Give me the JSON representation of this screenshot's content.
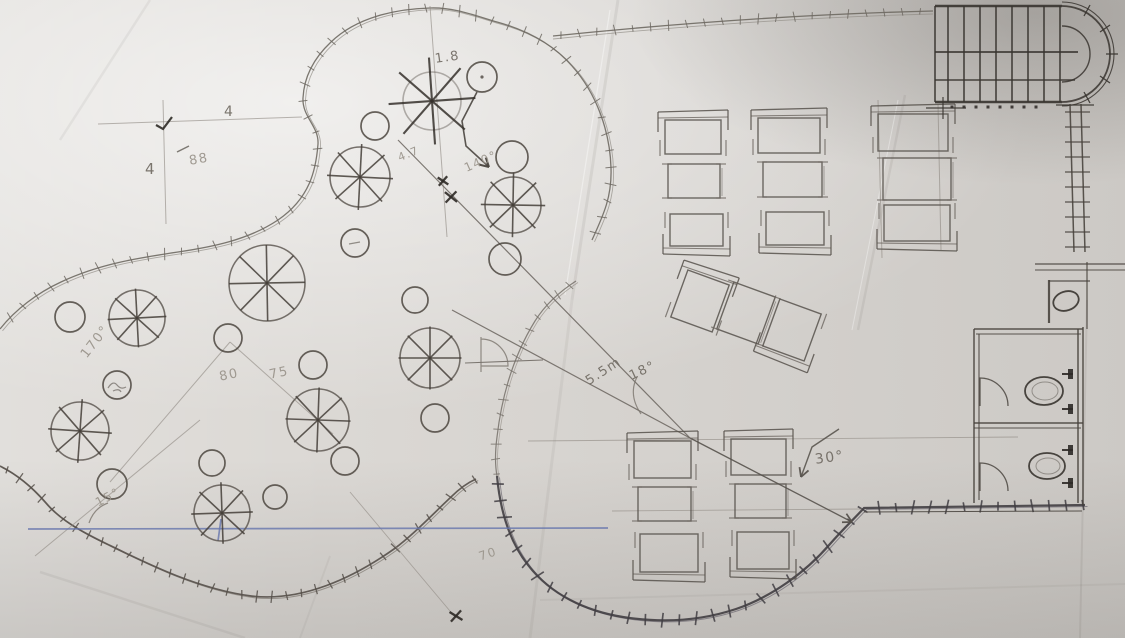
{
  "meta": {
    "canvas": {
      "w": 1125,
      "h": 638
    }
  },
  "palette": {
    "paper": "#dbd8d4",
    "pencil": "#6b655f",
    "pencil_faint": "#8d8780",
    "pencil_dark": "#3a3531",
    "ink_dark": "#413e43",
    "pen_blue": "#6776ad"
  },
  "annotations": [
    {
      "text": "1.8",
      "x": 434,
      "y": 52,
      "rot": -8,
      "size": 13,
      "tone": "normal"
    },
    {
      "text": "4",
      "x": 224,
      "y": 104,
      "rot": 0,
      "size": 14,
      "tone": "normal"
    },
    {
      "text": "4",
      "x": 145,
      "y": 160,
      "rot": 0,
      "size": 15,
      "tone": "normal"
    },
    {
      "text": "88",
      "x": 188,
      "y": 154,
      "rot": -10,
      "size": 13,
      "tone": "faint"
    },
    {
      "text": "4.7",
      "x": 396,
      "y": 152,
      "rot": -22,
      "size": 11,
      "tone": "faint"
    },
    {
      "text": "140°",
      "x": 462,
      "y": 162,
      "rot": -24,
      "size": 12,
      "tone": "faint"
    },
    {
      "text": "170°",
      "x": 78,
      "y": 352,
      "rot": -52,
      "size": 13,
      "tone": "faint"
    },
    {
      "text": "80",
      "x": 218,
      "y": 370,
      "rot": -12,
      "size": 13,
      "tone": "faint"
    },
    {
      "text": "75",
      "x": 268,
      "y": 368,
      "rot": -12,
      "size": 13,
      "tone": "faint"
    },
    {
      "text": "15°",
      "x": 93,
      "y": 497,
      "rot": -28,
      "size": 12,
      "tone": "faint"
    },
    {
      "text": "5.5m",
      "x": 583,
      "y": 376,
      "rot": -33,
      "size": 13,
      "tone": "normal"
    },
    {
      "text": "18°",
      "x": 627,
      "y": 370,
      "rot": -25,
      "size": 13,
      "tone": "normal"
    },
    {
      "text": "30°",
      "x": 814,
      "y": 452,
      "rot": -8,
      "size": 14,
      "tone": "normal"
    },
    {
      "text": "70",
      "x": 477,
      "y": 550,
      "rot": -18,
      "size": 12,
      "tone": "faint"
    }
  ],
  "sketch": {
    "boundaries": [
      {
        "name": "garden-boundary-top",
        "stroke": "#6e6962",
        "w": 1.3,
        "stroke2": "#908b84",
        "w2": 0.9,
        "off": [
          2.5,
          1.8
        ],
        "tick": 17,
        "ticklen": 9,
        "d": "M 592 240 C 604 214 612 196 611 168 C 610 132 597 94 572 66 C 552 43 526 30 497 22 C 476 16 454 7 430 8 C 396 9 357 17 331 42 C 314 58 304 77 303 98 C 302 117 319 126 318 144 C 316 170 310 198 278 220 C 248 240 212 247 178 252 C 138 258 99 264 61 282 C 37 293 15 310 0 329"
      },
      {
        "name": "garden-boundary-bottom-lobe",
        "stroke": "#56504a",
        "w": 1.7,
        "stroke2": "#7d7871",
        "w2": 1,
        "off": [
          2.2,
          1.6
        ],
        "tick": 15,
        "ticklen": 9,
        "d": "M 0 466 C 16 474 32 487 45 502 C 60 520 82 532 107 544 C 148 564 198 589 251 596 C 302 602 353 578 394 549 C 413 535 434 513 451 497 C 459 489 467 483 476 479"
      },
      {
        "name": "patio-circle-upper",
        "stroke": "#7b766f",
        "w": 1.2,
        "stroke2": "#968f88",
        "w2": 0.8,
        "off": [
          2,
          1.5
        ],
        "tick": 15,
        "ticklen": 8,
        "d": "M 576 281 C 559 292 545 305 535 321 C 514 355 502 394 497 437 C 495 452 495 465 497 476"
      },
      {
        "name": "patio-circle-lower-dark",
        "stroke": "#413e43",
        "w": 2.2,
        "stroke2": "#6c6870",
        "w2": 1,
        "off": [
          2.5,
          1.5
        ],
        "tick": 17,
        "ticklen": 11,
        "d": "M 497 476 C 500 509 509 541 528 565 C 551 595 586 611 623 617 C 661 623 700 621 736 609 C 771 597 805 573 830 544 C 844 528 855 518 864 508 L 1085 505"
      },
      {
        "name": "top-site-wall",
        "stroke": "#6e6962",
        "w": 1.3,
        "stroke2": "#908b84",
        "w2": 0.9,
        "off": [
          0,
          3
        ],
        "tick": 18,
        "ticklen": 8,
        "d": "M 553 36 C 680 23 810 14 933 11"
      }
    ],
    "lines": [
      [
        163,
        100,
        166,
        224,
        1.0,
        "faint"
      ],
      [
        98,
        124,
        302,
        117,
        1.0,
        "faint"
      ],
      [
        430,
        6,
        447,
        237,
        1.0,
        "faint"
      ],
      [
        398,
        140,
        690,
        438,
        1.2,
        "norm"
      ],
      [
        452,
        310,
        690,
        438,
        1.2,
        "norm"
      ],
      [
        230,
        342,
        110,
        482,
        1.0,
        "faint"
      ],
      [
        230,
        342,
        333,
        434,
        1.0,
        "faint"
      ],
      [
        200,
        420,
        35,
        556,
        1.0,
        "faint"
      ],
      [
        528,
        441,
        1018,
        437,
        0.9,
        "faint"
      ],
      [
        612,
        511,
        862,
        509,
        0.9,
        "faint"
      ],
      [
        465,
        363,
        543,
        360,
        1.1,
        "norm"
      ],
      [
        878,
        100,
        882,
        258,
        1.0,
        "faint"
      ],
      [
        938,
        104,
        941,
        250,
        1.0,
        "faint"
      ],
      [
        350,
        492,
        455,
        617,
        0.9,
        "faint"
      ],
      [
        177,
        152,
        189,
        146,
        1.5,
        "norm"
      ],
      [
        28,
        529,
        608,
        528,
        1.7,
        "blue"
      ],
      [
        221,
        519,
        218,
        541,
        1.7,
        "blue"
      ]
    ],
    "arcs": [
      "M 641 414 Q 628 395 637 377",
      "M 89 523 Q 94 508 108 503",
      "M 481 337 L 481 372 M 481 339 A 27 27 0 0 1 508 366 L 481 366"
    ],
    "arrows": [
      {
        "name": "curved-arrow",
        "pts": [
          [
            477,
            92
          ],
          [
            462,
            121
          ],
          [
            466,
            146
          ],
          [
            489,
            167
          ]
        ],
        "w": 1.6,
        "stroke": "#4a453f"
      },
      {
        "name": "dimension-arrow",
        "pts": [
          [
            690,
            438
          ],
          [
            852,
            522
          ]
        ],
        "w": 1.3,
        "stroke": "#57524c"
      },
      {
        "name": "angle-30-arrow",
        "pts": [
          [
            839,
            429
          ],
          [
            812,
            447
          ],
          [
            801,
            477
          ]
        ],
        "w": 1.4,
        "stroke": "#5a554f"
      }
    ],
    "trees": [
      {
        "x": 432,
        "y": 101,
        "r": 29,
        "s": 1.5,
        "faint": true,
        "dark": true
      },
      {
        "x": 360,
        "y": 177,
        "r": 30,
        "s": 1.1
      },
      {
        "x": 513,
        "y": 205,
        "r": 28,
        "s": 1.15
      },
      {
        "x": 267,
        "y": 283,
        "r": 38,
        "s": 1.0
      },
      {
        "x": 137,
        "y": 318,
        "r": 28,
        "s": 1.05
      },
      {
        "x": 80,
        "y": 431,
        "r": 29,
        "s": 1.1
      },
      {
        "x": 318,
        "y": 420,
        "r": 31,
        "s": 1.05
      },
      {
        "x": 430,
        "y": 358,
        "r": 30,
        "s": 1.05
      },
      {
        "x": 222,
        "y": 513,
        "r": 28,
        "s": 1.1
      }
    ],
    "shrubs": [
      {
        "x": 482,
        "y": 77,
        "r": 15,
        "dot": true
      },
      {
        "x": 375,
        "y": 126,
        "r": 14
      },
      {
        "x": 512,
        "y": 157,
        "r": 16
      },
      {
        "x": 355,
        "y": 243,
        "r": 14,
        "mark": "dash"
      },
      {
        "x": 505,
        "y": 259,
        "r": 16
      },
      {
        "x": 70,
        "y": 317,
        "r": 15
      },
      {
        "x": 415,
        "y": 300,
        "r": 13
      },
      {
        "x": 117,
        "y": 385,
        "r": 14,
        "mark": "scribble"
      },
      {
        "x": 228,
        "y": 338,
        "r": 14
      },
      {
        "x": 313,
        "y": 365,
        "r": 14
      },
      {
        "x": 435,
        "y": 418,
        "r": 14
      },
      {
        "x": 112,
        "y": 484,
        "r": 15
      },
      {
        "x": 212,
        "y": 463,
        "r": 13
      },
      {
        "x": 275,
        "y": 497,
        "r": 12
      },
      {
        "x": 345,
        "y": 461,
        "r": 14
      }
    ],
    "xmarks": [
      [
        443,
        181
      ],
      [
        451,
        197
      ],
      [
        456,
        616
      ]
    ],
    "checks": [
      [
        156,
        125,
        163,
        129,
        172,
        117
      ]
    ],
    "tables": [
      {
        "x": 665,
        "y": 120,
        "w": 56,
        "h": 34,
        "rot": 0,
        "band": "top"
      },
      {
        "x": 758,
        "y": 118,
        "w": 62,
        "h": 35,
        "rot": 0,
        "band": "top"
      },
      {
        "x": 878,
        "y": 114,
        "w": 70,
        "h": 37,
        "rot": 0,
        "band": "top"
      },
      {
        "x": 668,
        "y": 164,
        "w": 52,
        "h": 34,
        "rot": 0,
        "band": "none"
      },
      {
        "x": 763,
        "y": 162,
        "w": 59,
        "h": 35,
        "rot": 0,
        "band": "none"
      },
      {
        "x": 883,
        "y": 158,
        "w": 68,
        "h": 42,
        "rot": 0,
        "band": "none"
      },
      {
        "x": 670,
        "y": 214,
        "w": 53,
        "h": 32,
        "rot": 0,
        "band": "bottom"
      },
      {
        "x": 766,
        "y": 212,
        "w": 58,
        "h": 33,
        "rot": 0,
        "band": "bottom"
      },
      {
        "x": 884,
        "y": 205,
        "w": 66,
        "h": 36,
        "rot": 0,
        "band": "bottom"
      },
      {
        "x": 678,
        "y": 276,
        "w": 44,
        "h": 50,
        "rot": 20,
        "band": "top"
      },
      {
        "x": 724,
        "y": 288,
        "w": 44,
        "h": 50,
        "rot": 20,
        "band": "none"
      },
      {
        "x": 770,
        "y": 305,
        "w": 44,
        "h": 50,
        "rot": 20,
        "band": "bottom"
      },
      {
        "x": 634,
        "y": 441,
        "w": 57,
        "h": 37,
        "rot": 0,
        "band": "top"
      },
      {
        "x": 731,
        "y": 439,
        "w": 55,
        "h": 36,
        "rot": 0,
        "band": "top"
      },
      {
        "x": 638,
        "y": 487,
        "w": 53,
        "h": 34,
        "rot": 0,
        "band": "none"
      },
      {
        "x": 735,
        "y": 484,
        "w": 51,
        "h": 34,
        "rot": 0,
        "band": "none"
      },
      {
        "x": 640,
        "y": 534,
        "w": 58,
        "h": 38,
        "rot": 0,
        "band": "bottom"
      },
      {
        "x": 737,
        "y": 532,
        "w": 52,
        "h": 37,
        "rot": 0,
        "band": "bottom"
      }
    ],
    "stairs": {
      "lines": [
        [
          935,
          6,
          1062,
          6,
          2.4
        ],
        [
          935,
          52,
          1078,
          52,
          1.8
        ],
        [
          935,
          80,
          1075,
          80,
          1.4
        ],
        [
          935,
          102,
          1062,
          102,
          2.4
        ],
        [
          935,
          6,
          935,
          102,
          1.6
        ],
        [
          948,
          6,
          948,
          102,
          1.6
        ],
        [
          964,
          6,
          964,
          102,
          1.6
        ],
        [
          980,
          6,
          980,
          102,
          1.6
        ],
        [
          996,
          6,
          996,
          102,
          1.6
        ],
        [
          1012,
          6,
          1012,
          102,
          1.6
        ],
        [
          1028,
          6,
          1028,
          102,
          1.6
        ],
        [
          1044,
          6,
          1044,
          102,
          1.6
        ],
        [
          1060,
          6,
          1060,
          102,
          1.6
        ],
        [
          926,
          108,
          966,
          108,
          1.2
        ],
        [
          943,
          97,
          943,
          119,
          1.2
        ],
        [
          1056,
          105,
          1094,
          105,
          1.2
        ],
        [
          1084,
          16,
          1090,
          5,
          1.3
        ],
        [
          1100,
          32,
          1110,
          25,
          1.3
        ],
        [
          1106,
          54,
          1118,
          54,
          1.3
        ],
        [
          1100,
          76,
          1110,
          83,
          1.3
        ],
        [
          1084,
          92,
          1090,
          103,
          1.3
        ]
      ],
      "paths": [
        {
          "d": "M 1062 6 A 48 48 0 0 1 1110 54 A 48 48 0 0 1 1062 102",
          "w": 1.8
        },
        {
          "d": "M 1062 2 A 52 52 0 0 1 1114 54 A 52 52 0 0 1 1062 106",
          "w": 1.1
        },
        {
          "d": "M 1062 26 A 28 28 0 0 1 1090 54 A 28 28 0 0 1 1062 82",
          "w": 1.4
        }
      ],
      "dots": [
        [
          952,
          107
        ],
        [
          964,
          107
        ],
        [
          976,
          107
        ],
        [
          988,
          107
        ],
        [
          1000,
          107
        ],
        [
          1012,
          107
        ],
        [
          1024,
          107
        ],
        [
          1036,
          107
        ]
      ]
    },
    "walls": {
      "lines": [
        [
          1070,
          104,
          1074,
          252,
          1.5
        ],
        [
          1081,
          104,
          1085,
          252,
          1.5
        ],
        [
          1065,
          112,
          1090,
          112,
          1.3
        ],
        [
          1065,
          127,
          1090,
          127,
          1.3
        ],
        [
          1065,
          142,
          1090,
          142,
          1.3
        ],
        [
          1065,
          157,
          1090,
          157,
          1.3
        ],
        [
          1065,
          172,
          1090,
          172,
          1.3
        ],
        [
          1065,
          187,
          1090,
          187,
          1.3
        ],
        [
          1065,
          202,
          1090,
          202,
          1.3
        ],
        [
          1065,
          217,
          1090,
          217,
          1.3
        ],
        [
          1065,
          232,
          1090,
          232,
          1.3
        ],
        [
          1065,
          247,
          1090,
          247,
          1.3
        ],
        [
          974,
          329,
          974,
          503,
          1.5
        ],
        [
          979,
          334,
          979,
          500,
          1.1
        ],
        [
          974,
          329,
          1083,
          329,
          1.5
        ],
        [
          976,
          334,
          1081,
          334,
          1.1
        ],
        [
          1078,
          329,
          1078,
          503,
          1.5
        ],
        [
          1083,
          327,
          1083,
          505,
          1.5
        ],
        [
          974,
          423,
          1083,
          423,
          1.5
        ],
        [
          974,
          428,
          1081,
          428,
          1.1
        ],
        [
          1049,
          280,
          1049,
          323,
          2.2
        ],
        [
          1049,
          281,
          1090,
          281,
          1.2
        ],
        [
          1087,
          262,
          1087,
          329,
          1.2
        ],
        [
          1035,
          264,
          1125,
          264,
          1.3
        ],
        [
          1035,
          270,
          1125,
          270,
          1.1
        ],
        [
          864,
          512,
          1082,
          511,
          1.0
        ]
      ],
      "doors": [
        "M 980 406 L 980 378 A 28 28 0 0 1 1008 406",
        "M 980 491 L 980 463 A 28 28 0 0 1 1008 491"
      ],
      "toilets": [
        {
          "cx": 1044,
          "cy": 391,
          "rx": 19,
          "ry": 14,
          "br": [
            [
              1070,
              374
            ],
            [
              1070,
              409
            ]
          ]
        },
        {
          "cx": 1047,
          "cy": 466,
          "rx": 18,
          "ry": 13,
          "br": [
            [
              1070,
              450
            ],
            [
              1070,
              483
            ]
          ]
        }
      ],
      "sink": {
        "cx": 1066,
        "cy": 301,
        "rx": 13,
        "ry": 9.5,
        "rot": -18
      }
    },
    "creases": [
      {
        "x1": 618,
        "y1": 0,
        "x2": 572,
        "y2": 300,
        "w": 3,
        "op": 0.1
      },
      {
        "x1": 572,
        "y1": 300,
        "x2": 530,
        "y2": 638,
        "w": 3,
        "op": 0.08
      },
      {
        "x1": 905,
        "y1": 95,
        "x2": 858,
        "y2": 330,
        "w": 2.5,
        "op": 0.1
      },
      {
        "x1": 1087,
        "y1": 300,
        "x2": 1080,
        "y2": 638,
        "w": 2,
        "op": 0.12
      },
      {
        "x1": 40,
        "y1": 572,
        "x2": 245,
        "y2": 638,
        "w": 2.5,
        "op": 0.09
      },
      {
        "x1": 540,
        "y1": 600,
        "x2": 1125,
        "y2": 584,
        "w": 2,
        "op": 0.07
      },
      {
        "x1": 300,
        "y1": 638,
        "x2": 330,
        "y2": 556,
        "w": 2,
        "op": 0.07
      },
      {
        "x1": 150,
        "y1": 0,
        "x2": 60,
        "y2": 140,
        "w": 2.5,
        "op": 0.08
      },
      {
        "x1": 610,
        "y1": 10,
        "x2": 565,
        "y2": 295,
        "w": 1.2,
        "op": 0.4,
        "light": true
      },
      {
        "x1": 898,
        "y1": 100,
        "x2": 852,
        "y2": 330,
        "w": 1,
        "op": 0.35,
        "light": true
      }
    ]
  }
}
